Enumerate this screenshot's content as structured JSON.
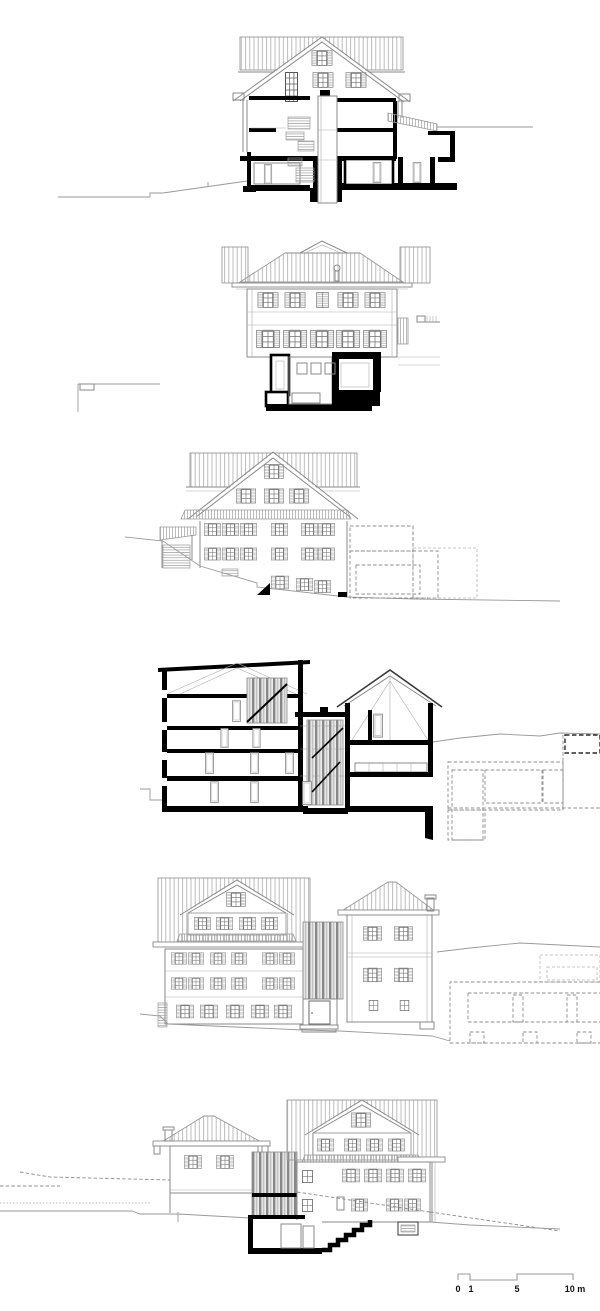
{
  "document": {
    "kind": "architectural drawing sheet",
    "background": "#ffffff",
    "drawings": [
      {
        "name": "cross-section"
      },
      {
        "name": "side-elevation-with-basement-section"
      },
      {
        "name": "gable-elevation"
      },
      {
        "name": "longitudinal-section"
      },
      {
        "name": "street-elevation"
      },
      {
        "name": "rear-elevation"
      }
    ]
  },
  "scale_bar": {
    "label_0": "0",
    "label_1": "1",
    "label_5": "5",
    "label_10": "10 m"
  },
  "colors": {
    "cut_poche": "#000000",
    "elevation_line": "#8a8a8a",
    "roof_hatch": "#b3b3b3",
    "dashed_outline": "#8c8c8c"
  }
}
